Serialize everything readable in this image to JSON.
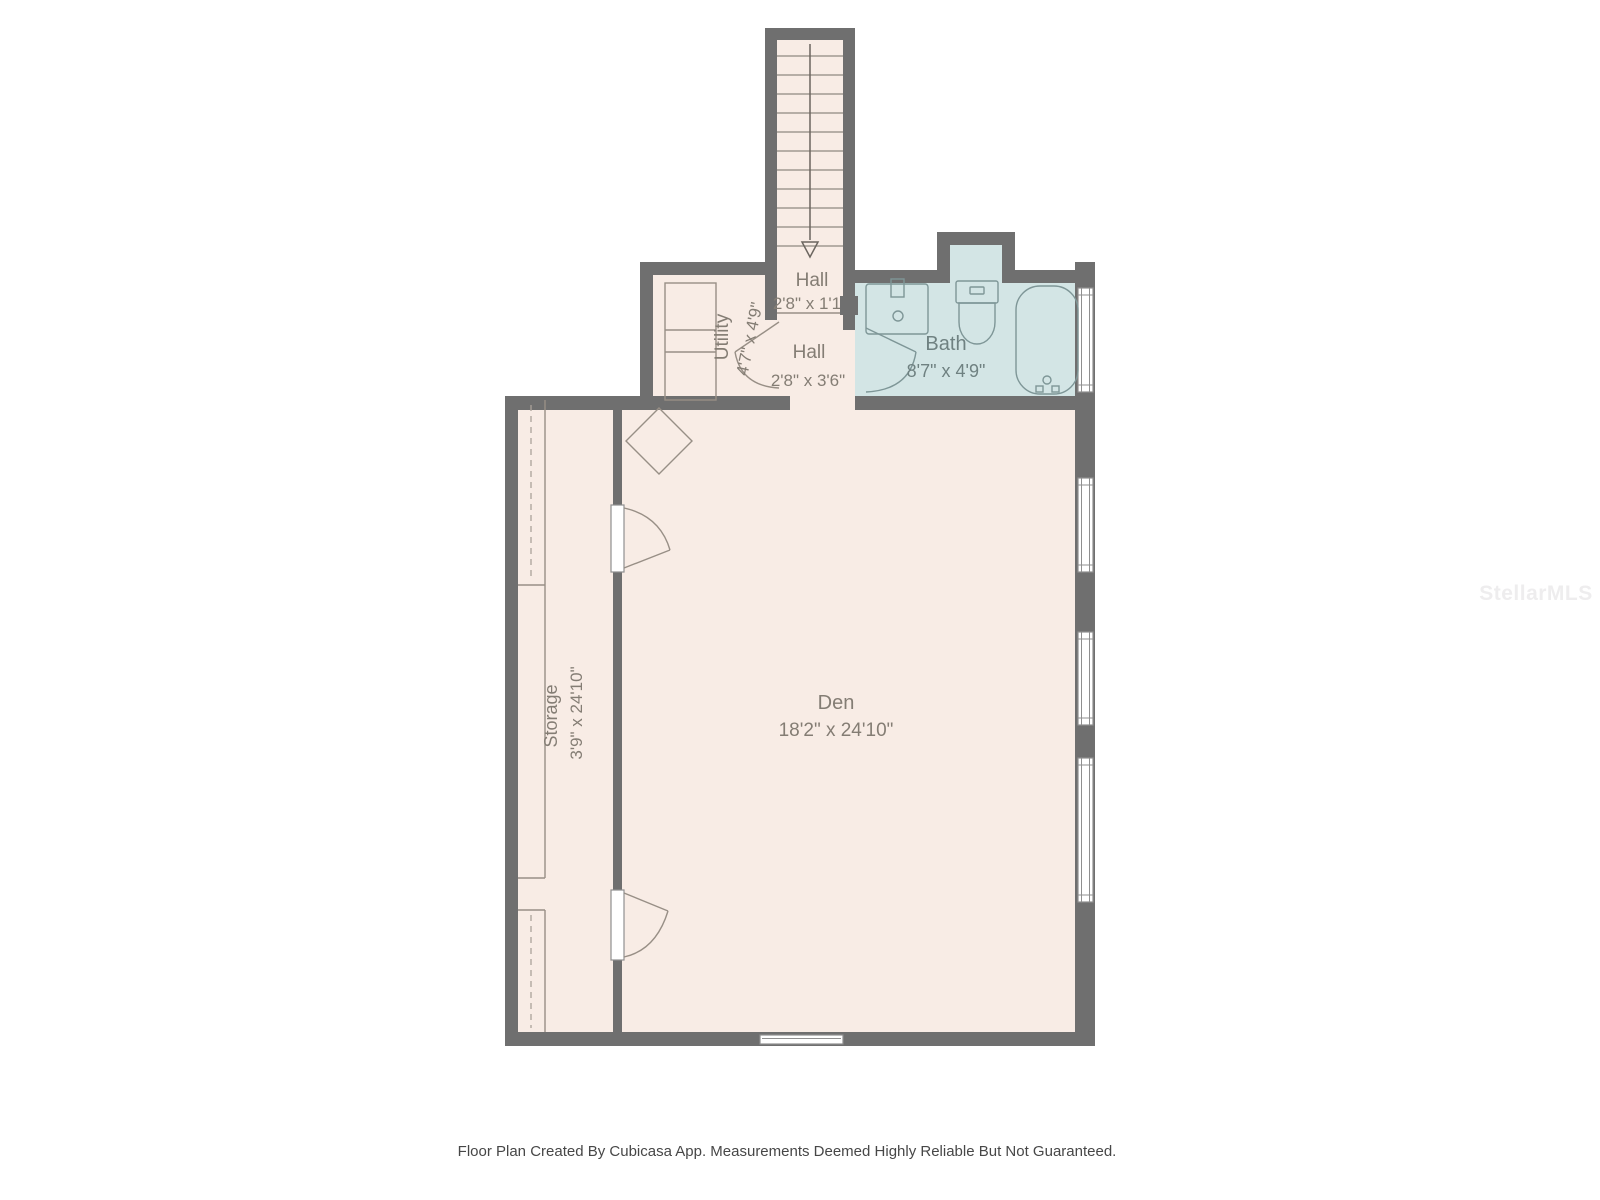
{
  "plan": {
    "rooms": {
      "hall_upper": {
        "label": "Hall",
        "dims": "2'8\" x 1'1\""
      },
      "hall_lower": {
        "label": "Hall",
        "dims": "2'8\" x 3'6\""
      },
      "utility": {
        "label": "Utility",
        "dims": "4'7\" x 4'9\""
      },
      "bath": {
        "label": "Bath",
        "dims": "8'7\" x 4'9\""
      },
      "den": {
        "label": "Den",
        "dims": "18'2\" x 24'10\""
      },
      "storage": {
        "label": "Storage",
        "dims": "3'9\" x 24'10\""
      }
    },
    "colors": {
      "wall": "#6f6f6f",
      "floor": "#f8ece5",
      "wet_floor": "#d3e5e5",
      "label_text": "#847d74",
      "bath_text": "#6f8181"
    }
  },
  "footer": {
    "disclaimer": "Floor Plan Created By Cubicasa App. Measurements Deemed Highly Reliable But Not Guaranteed."
  },
  "watermark": {
    "text": "StellarMLS"
  }
}
